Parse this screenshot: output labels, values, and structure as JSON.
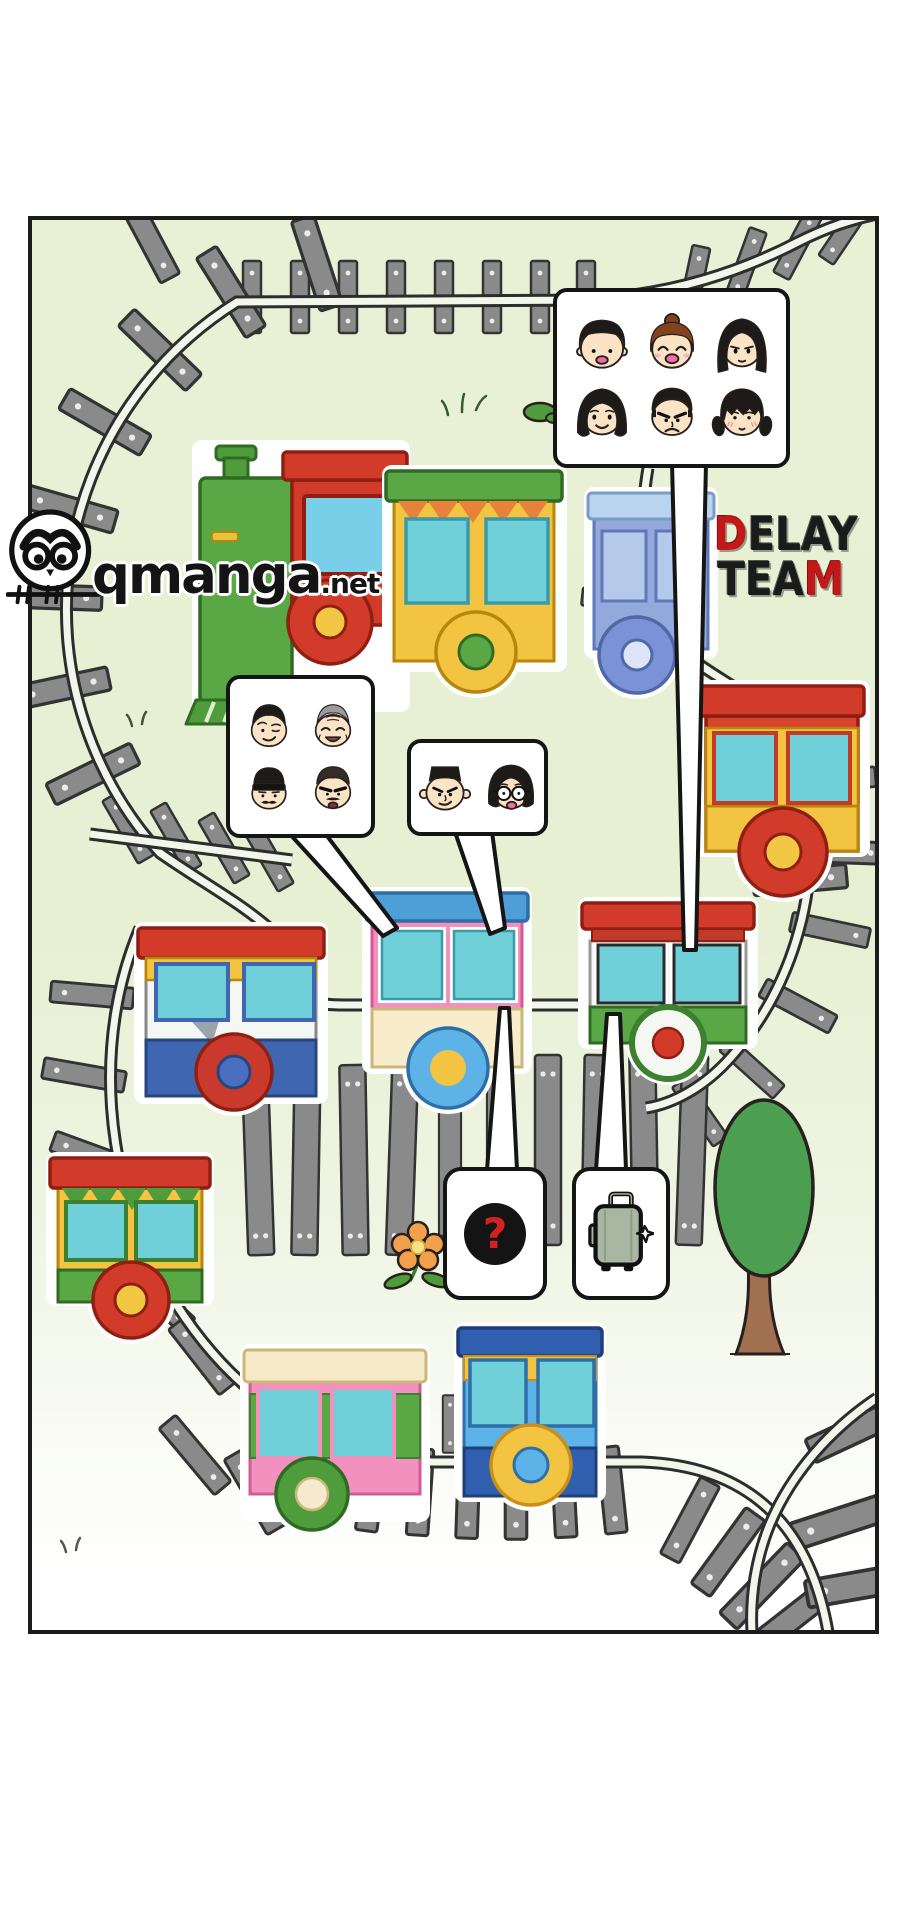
{
  "comic": {
    "panel_bg_top": "#e7f0d3",
    "panel_bg_bottom": "#ffffff",
    "panel_border": "#1c1c1c",
    "watermark": {
      "owl_icon": "owl-logo-icon",
      "site": "qmanga",
      "tld": ".net"
    },
    "team_logo": {
      "word1_first": "D",
      "word1_rest": "ELAY",
      "word2_first": "TEA",
      "word2_last": "M",
      "red": "#c41818",
      "dark": "#1b1b1b"
    },
    "bubbles": {
      "passengers": {
        "faces": [
          "boy-bowlcut",
          "woman-hairbun",
          "woman-longhair",
          "woman-midhair",
          "man-angry",
          "girl-pigtails"
        ]
      },
      "crew": {
        "faces": [
          "man-smirk",
          "oldman-gray",
          "man-beanie",
          "man-buzzcut"
        ]
      },
      "couple": {
        "faces": [
          "man-flattop",
          "woman-bob-glasses"
        ]
      },
      "mystery": {
        "symbol": "?",
        "symbol_color": "#d42222",
        "disc_color": "#141414"
      },
      "luggage": {
        "icon": "suitcase-icon"
      }
    },
    "scenery": {
      "tree": "tree-icon",
      "flower": "flower-icon",
      "bush": "bush-icon",
      "grass": "grass-tuft-icon"
    },
    "train_palette": {
      "red": "#d23b2a",
      "green": "#5aa845",
      "yellow": "#f2c441",
      "teal": "#6fd0da",
      "pink": "#f291be",
      "blue": "#3f66b0",
      "sky": "#5db3e8",
      "periwinkle": "#93a9dc",
      "cream": "#f8edca"
    }
  }
}
